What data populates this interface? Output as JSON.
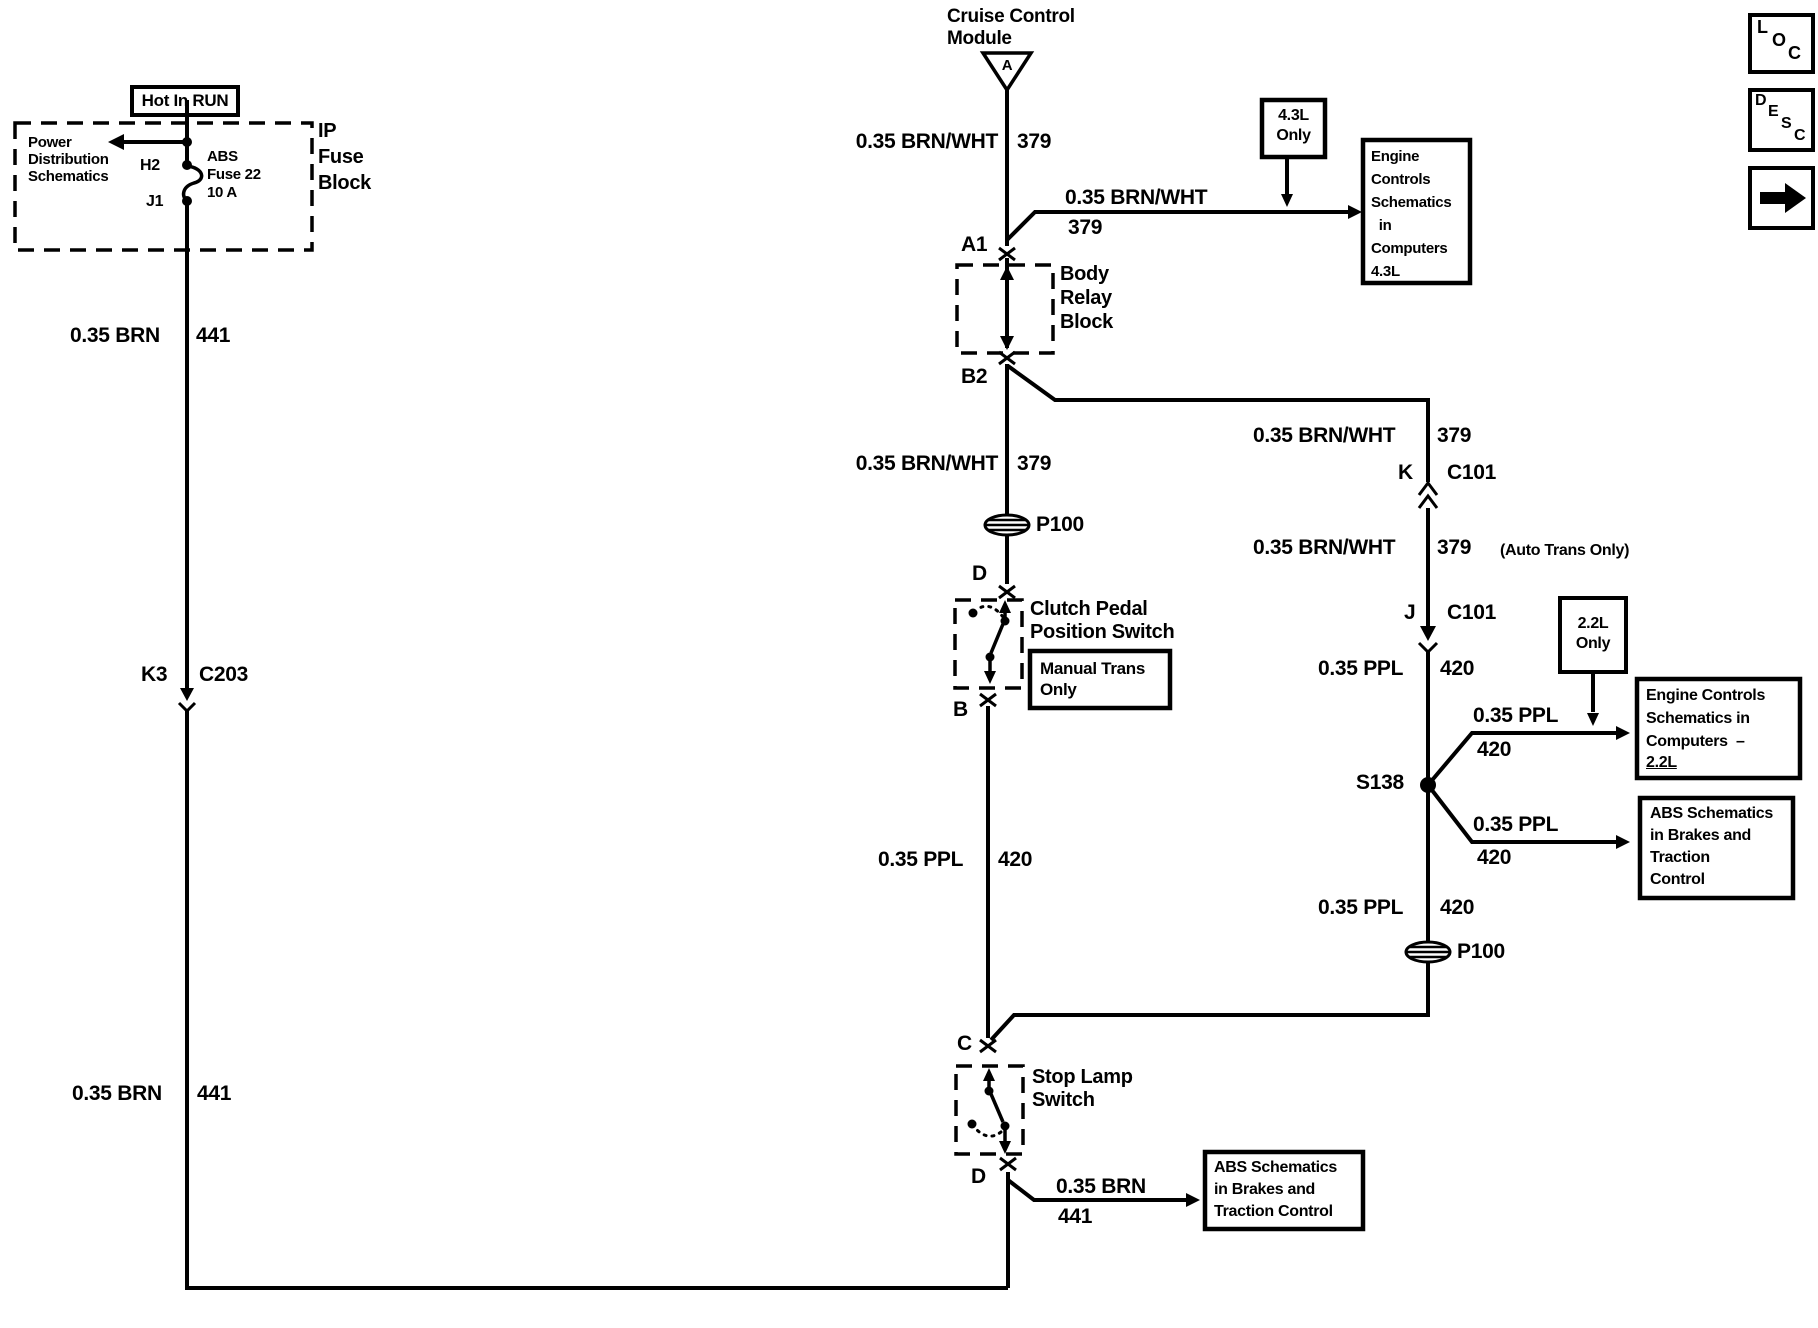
{
  "colors": {
    "ink": "#000000",
    "paper": "#ffffff"
  },
  "power": {
    "hot_in_run": "Hot In RUN",
    "power_dist": "Power\nDistribution\nSchematics",
    "pin_h2": "H2",
    "pin_j1": "J1",
    "fuse_label": "ABS\nFuse 22\n10 A",
    "fuse_block": "IP\nFuse\nBlock"
  },
  "cruise": {
    "label": "Cruise Control\nModule",
    "pin": "A"
  },
  "corner": {
    "loc": [
      "L",
      "O",
      "C"
    ],
    "desc": [
      "D",
      "E",
      "S",
      "C"
    ],
    "arrow_icon": "forward-arrow"
  },
  "left_wire": {
    "upper": {
      "spec": "0.35 BRN",
      "circuit": "441"
    },
    "connector": {
      "pin": "K3",
      "name": "C203"
    },
    "lower": {
      "spec": "0.35 BRN",
      "circuit": "441"
    }
  },
  "center_wire": {
    "seg1": {
      "spec": "0.35 BRN/WHT",
      "circuit": "379"
    },
    "pin_a1": "A1",
    "body_relay": "Body\nRelay\nBlock",
    "pin_b2": "B2",
    "seg2": {
      "spec": "0.35 BRN/WHT",
      "circuit": "379"
    },
    "grommet": "P100",
    "pin_d": "D",
    "clutch_switch": "Clutch Pedal\nPosition Switch",
    "manual_trans": "Manual Trans\nOnly",
    "pin_b": "B",
    "seg3": {
      "spec": "0.35 PPL",
      "circuit": "420"
    },
    "pin_c": "C",
    "stop_lamp": "Stop Lamp\nSwitch",
    "pin_d2": "D",
    "out": {
      "spec": "0.35 BRN",
      "circuit": "441"
    },
    "dest_abs": "ABS Schematics\nin Brakes and\nTraction Control"
  },
  "branch_43l": {
    "spec": "0.35 BRN/WHT",
    "circuit": "379",
    "tag": "4.3L\nOnly",
    "dest": "Engine\nControls\nSchematics\n  in\nComputers\n4.3L"
  },
  "right_wire": {
    "seg1": {
      "spec": "0.35 BRN/WHT",
      "circuit": "379"
    },
    "conn_k": {
      "pin": "K",
      "name": "C101"
    },
    "seg2": {
      "spec": "0.35 BRN/WHT",
      "circuit": "379",
      "note": "(Auto Trans Only)"
    },
    "conn_j": {
      "pin": "J",
      "name": "C101"
    },
    "seg3": {
      "spec": "0.35 PPL",
      "circuit": "420"
    },
    "splice": "S138",
    "branch_22l": {
      "spec": "0.35 PPL",
      "circuit": "420",
      "tag": "2.2L\nOnly",
      "dest_main": "Engine Controls\nSchematics in\nComputers  –",
      "dest_sub": "2.2L"
    },
    "branch_abs": {
      "spec": "0.35 PPL",
      "circuit": "420",
      "dest": "ABS Schematics\nin Brakes and\nTraction\nControl"
    },
    "seg4": {
      "spec": "0.35 PPL",
      "circuit": "420"
    },
    "grommet": "P100"
  }
}
